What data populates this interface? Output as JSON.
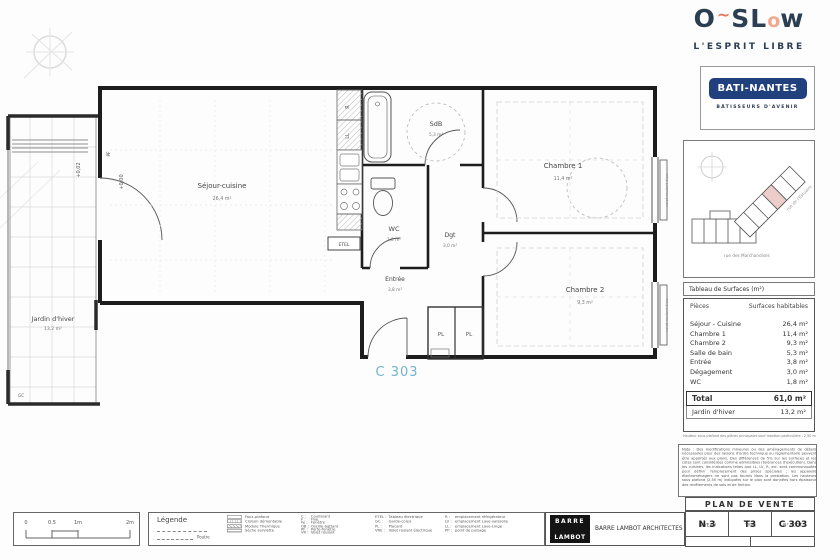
{
  "colors": {
    "navy": "#2c3e52",
    "orange": "#e2795b",
    "peach": "#f0a98e",
    "brand_blue": "#21417e",
    "unit_blue": "#74b3cb",
    "highlight_pink": "#eccdca"
  },
  "branding": {
    "logo": {
      "o1": "O",
      "tilde": "~",
      "sl": "SL",
      "o2": "o",
      "w": "w"
    },
    "tagline": "L'ESPRIT LIBRE",
    "builder": "BATI-NANTES",
    "builder_tagline": "BÂTISSEURS D'AVENIR"
  },
  "location_map": {
    "street_main": "rue des Marchandises",
    "street_side": "rue de l'Estuaire"
  },
  "plan": {
    "rooms": {
      "sejour": {
        "name": "Séjour-cuisine",
        "area": "26,4 m²"
      },
      "jardin": {
        "name": "Jardin d'hiver",
        "area": "13,2 m²"
      },
      "sdb": {
        "name": "SdB",
        "area": "5,3 m²"
      },
      "wc": {
        "name": "WC",
        "area": "1,8 m²"
      },
      "dgt": {
        "name": "Dgt",
        "area": "3,0 m²"
      },
      "entree": {
        "name": "Entrée",
        "area": "3,8 m²"
      },
      "chambre1": {
        "name": "Chambre 1",
        "area": "11,4 m²"
      },
      "chambre2": {
        "name": "Chambre 2",
        "area": "9,3 m²"
      }
    },
    "annotations": {
      "unit": "C 303",
      "level_main": "+0,00",
      "level_jardin": "+0,02",
      "pf": "PF",
      "gc": "GC",
      "etel": "ETEL",
      "pl1": "PL",
      "pl2": "PL",
      "r": "R",
      "ll": "LL",
      "vr1": "volet roulant élec.",
      "vr2": "volet roulant élec."
    }
  },
  "surface_table": {
    "box_title": "Tableau de Surfaces (m²)",
    "col_rooms": "Pièces",
    "col_area": "Surfaces habitables",
    "rows": [
      {
        "label": "Séjour - Cuisine",
        "value": "26,4 m²"
      },
      {
        "label": "Chambre 1",
        "value": "11,4 m²"
      },
      {
        "label": "Chambre 2",
        "value": "9,3 m²"
      },
      {
        "label": "Salle de bain",
        "value": "5,3 m²"
      },
      {
        "label": "Entrée",
        "value": "3,8 m²"
      },
      {
        "label": "Dégagement",
        "value": "3,0 m²"
      },
      {
        "label": "WC",
        "value": "1,8 m²"
      }
    ],
    "total_label": "Total",
    "total_value": "61,0 m²",
    "annex_label": "Jardin d'hiver",
    "annex_value": "13,2 m²",
    "footnote": "Hauteur sous plafond des pièces principales sauf mention particulière : 2,50 m"
  },
  "nota": {
    "text": "Nota : Des modifications mineures ou des aménagements de détails nécessaires pour des raisons d'ordre technique ou réglementaire peuvent être apportés aux plans. Des différences de 5% sur les surfaces et les cotes sont considérées comme admissibles (tolérances d'exécution). Dans les cuisines, les indications telles que LL, LV, R, etc. sont communiquées pour définir l'emplacement des prises spéciales ; les appareils électroménagers ne sont pas fournis dans la prestation. Les hauteurs sous plafond (2,50 m) indiquées sur le plan sont données hors épaisseur des revêtements de sols et de finition."
  },
  "legend": {
    "scale_ticks": [
      "0",
      "0.5",
      "1m",
      "2m"
    ],
    "title": "Légende",
    "beam_label": "Poutre",
    "symbols": [
      {
        "label": "Faux-plafond"
      },
      {
        "label": "Cloison démontable"
      },
      {
        "label": "Module Thermique"
      },
      {
        "label": "Sèche serviette"
      }
    ],
    "abbr1": [
      {
        "k": "C :",
        "v": "Coulissant"
      },
      {
        "k": "F :",
        "v": "Fixe"
      },
      {
        "k": "Fe :",
        "v": "Fenêtre"
      },
      {
        "k": "OB :",
        "v": "Oscillo-battant"
      },
      {
        "k": "PF :",
        "v": "Porte-fenêtre"
      },
      {
        "k": "VR :",
        "v": "Volet roulant"
      }
    ],
    "abbr2": [
      {
        "k": "ETEL :",
        "v": "Tableau électrique"
      },
      {
        "k": "GC :",
        "v": "Garde-corps"
      },
      {
        "k": "PL :",
        "v": "Placard"
      },
      {
        "k": "VRE :",
        "v": "Volet roulant électrique"
      }
    ],
    "abbr3": [
      {
        "k": "R :",
        "v": "emplacement réfrigérateur"
      },
      {
        "k": "LV :",
        "v": "emplacement Lave-vaisselle"
      },
      {
        "k": "LL :",
        "v": "emplacement Lave-Linge"
      },
      {
        "k": "PP :",
        "v": "point de puisage"
      }
    ]
  },
  "title_block": {
    "heading": "PLAN DE VENTE",
    "architect_logo_top": "BARRE",
    "architect_logo_bottom": "LAMBOT",
    "architect_name": "BARRE LAMBOT ARCHITECTES",
    "niveau_label": "NIVEAU",
    "niveau_value": "N 3",
    "type_label": "TYPE",
    "type_value": "T3",
    "logt_label": "N° LOGT",
    "logt_value": "C 303",
    "edition": "Première édition : 04/04/2018",
    "update": "mise à jour : 25/07/2018"
  }
}
